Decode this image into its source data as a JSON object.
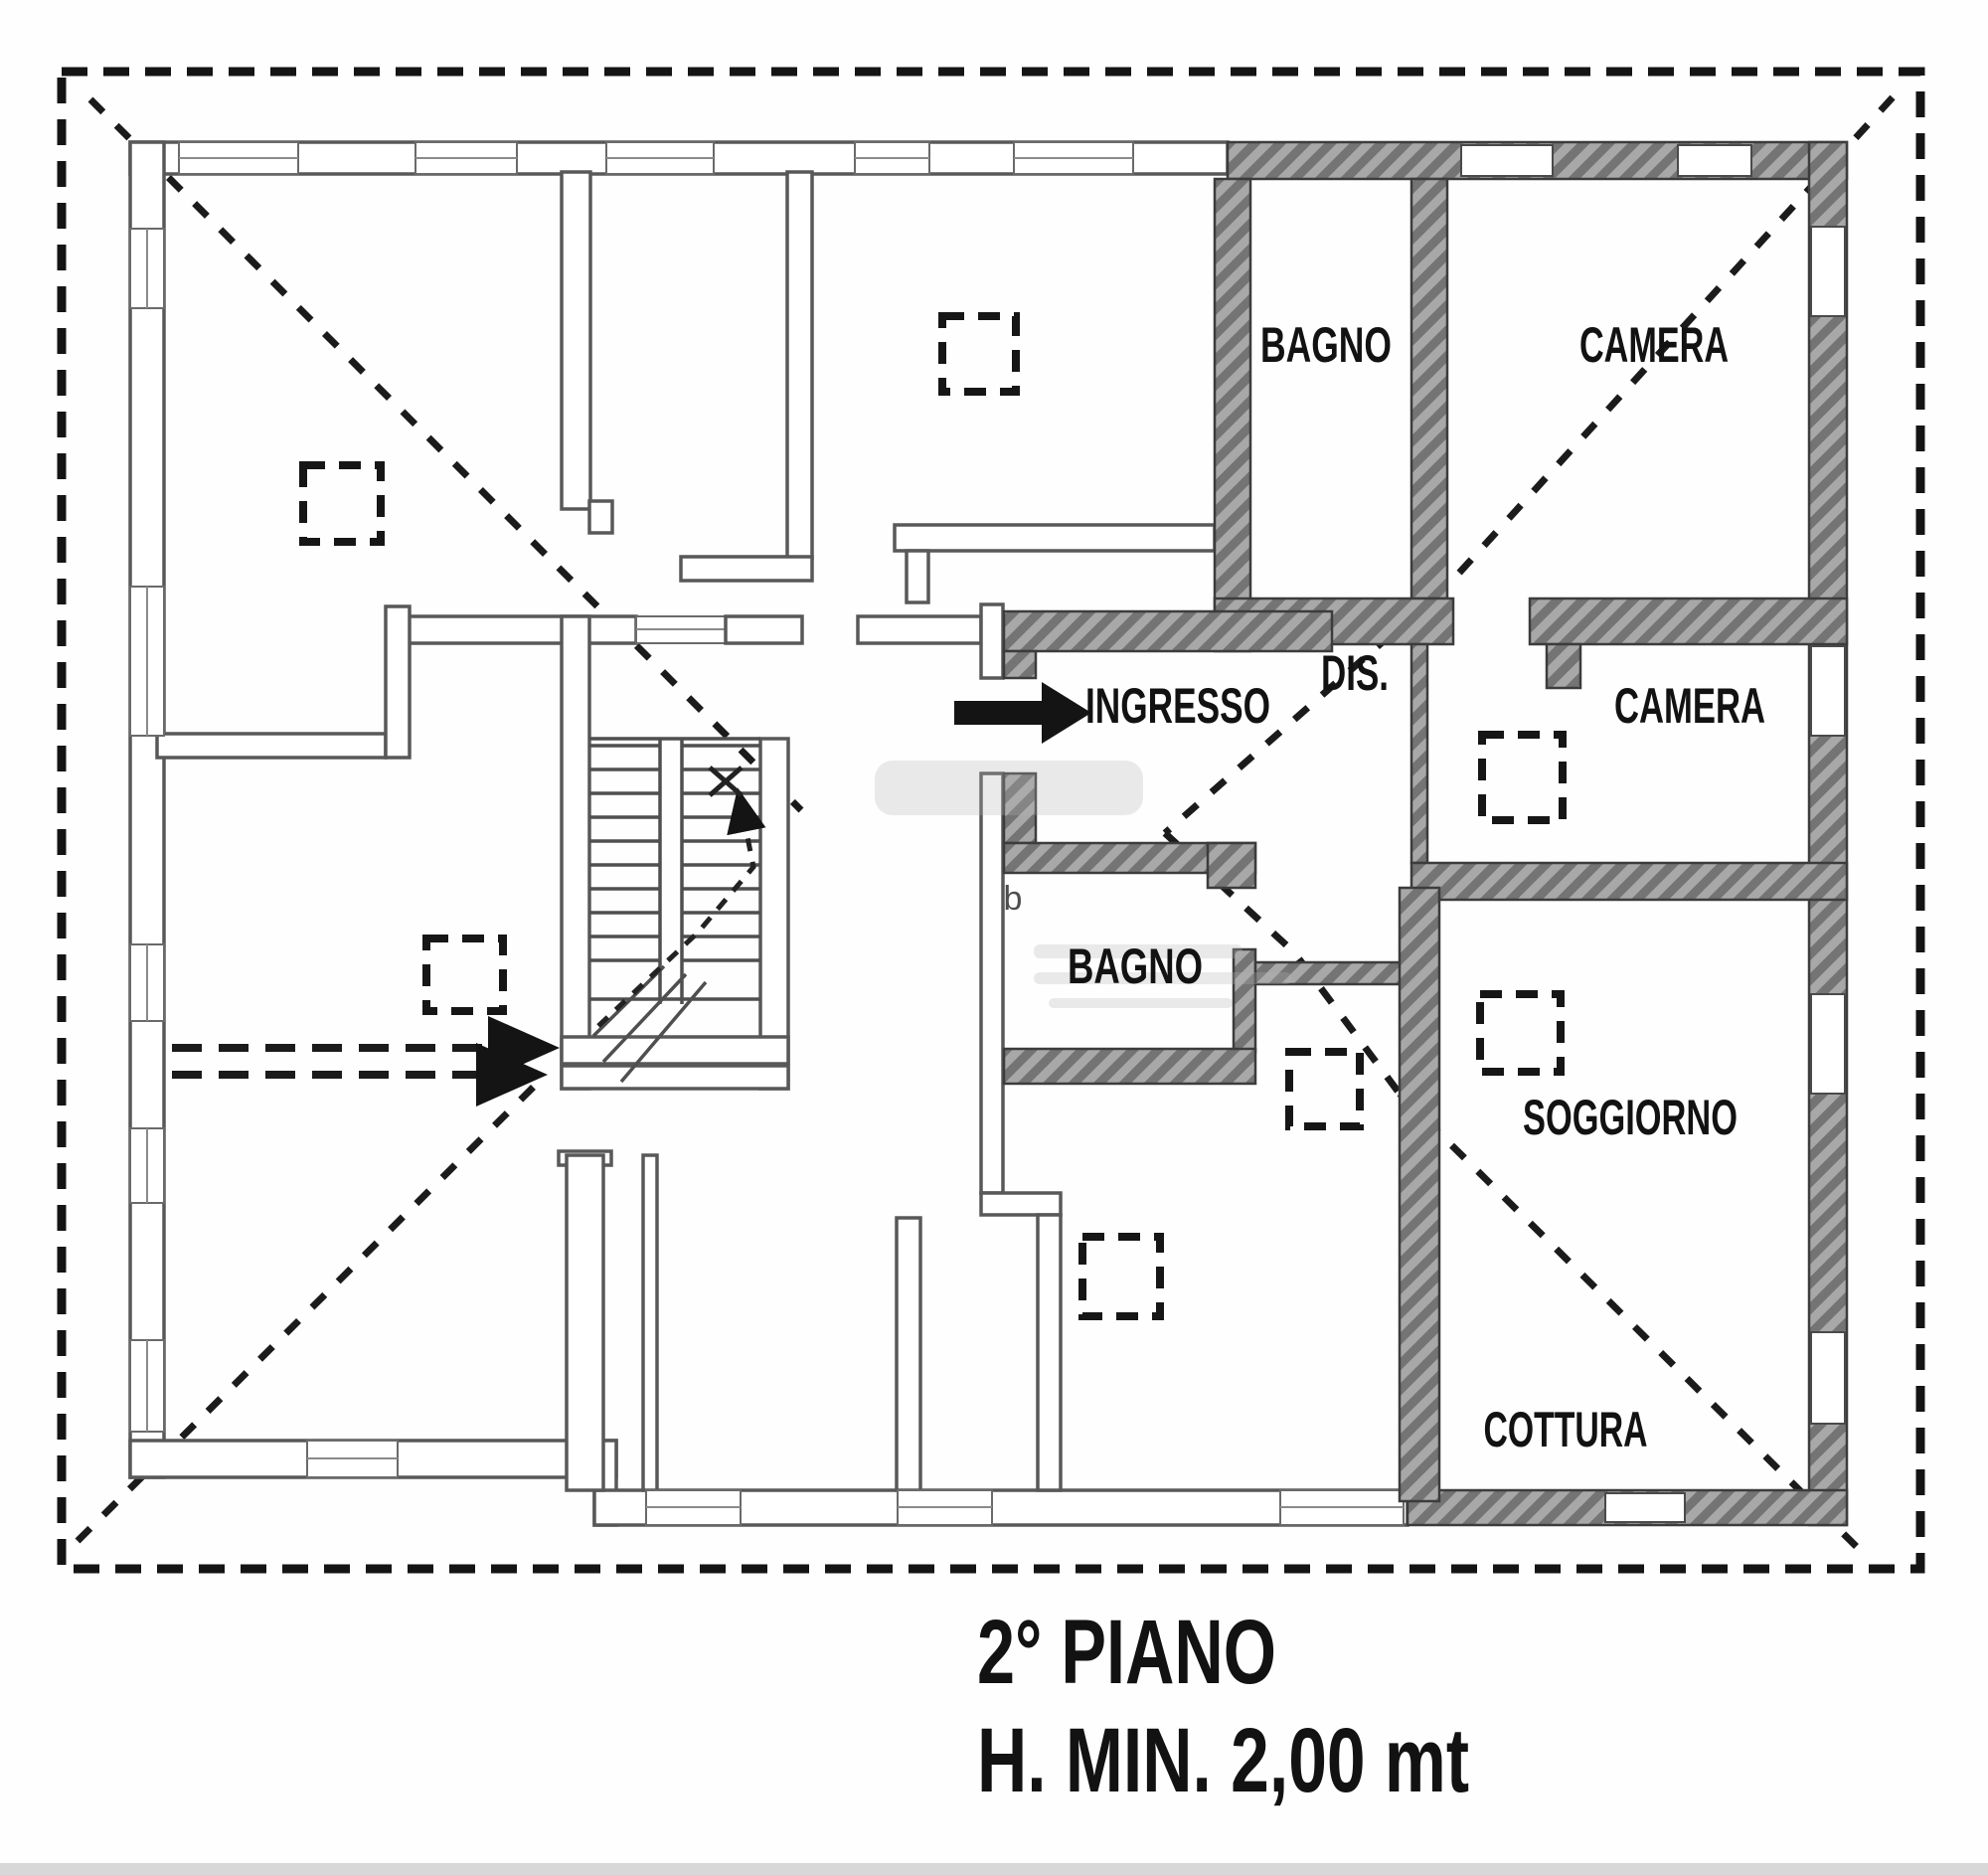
{
  "plan": {
    "type": "floor-plan",
    "rooms": [
      {
        "id": "bagno-top",
        "label": "BAGNO"
      },
      {
        "id": "camera-top",
        "label": "CAMERA"
      },
      {
        "id": "dis",
        "label": "DIS."
      },
      {
        "id": "ingresso",
        "label": "INGRESSO"
      },
      {
        "id": "camera-right",
        "label": "CAMERA"
      },
      {
        "id": "bagno-center",
        "label": "BAGNO"
      },
      {
        "id": "soggiorno",
        "label": "SOGGIORNO"
      },
      {
        "id": "cottura",
        "label": "COTTURA"
      }
    ],
    "annotations": {
      "door_letter": "b",
      "entrance_arrow_direction": "right"
    },
    "caption": {
      "line1": "2° PIANO",
      "line2": "H. MIN. 2,00 mt"
    },
    "colors": {
      "paper": "#fefefe",
      "ink": "#141414",
      "thin_wall": "#585858",
      "hatch_dark": "#747474",
      "hatch_light": "#a8a8a8",
      "wall_border": "#3c3c3c"
    }
  }
}
